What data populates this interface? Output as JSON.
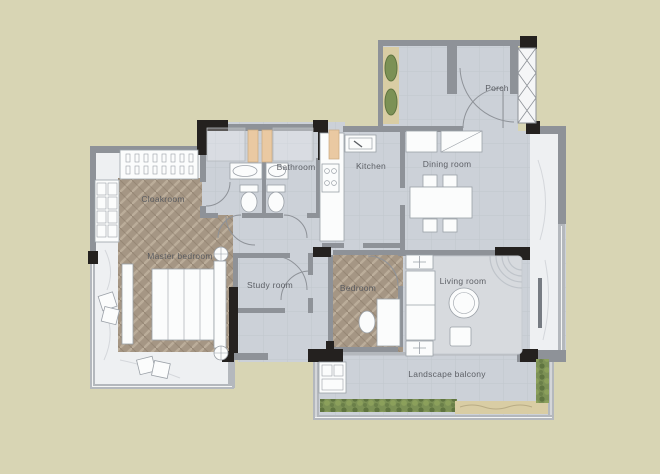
{
  "plan": {
    "title": "Apartment floor plan",
    "rooms": [
      {
        "id": "porch",
        "label": "Porch"
      },
      {
        "id": "bathroom",
        "label": "Bathroom"
      },
      {
        "id": "kitchen",
        "label": "Kitchen"
      },
      {
        "id": "dining-room",
        "label": "Dining room"
      },
      {
        "id": "cloakroom",
        "label": "Cloakroom"
      },
      {
        "id": "master-bedroom",
        "label": "Master bedroom"
      },
      {
        "id": "study-room",
        "label": "Study room"
      },
      {
        "id": "bedroom",
        "label": "Bedroom"
      },
      {
        "id": "living-room",
        "label": "Living room"
      },
      {
        "id": "landscape-balcony",
        "label": "Landscape balcony"
      }
    ],
    "colors": {
      "bg": "#d8d5b4",
      "tile": "#ccd1d8",
      "tileLine": "#b7bdc5",
      "wood": "#a59684",
      "marble": "#eef0f2",
      "wallGray": "#8e9298",
      "wallLight": "#b4b8bd",
      "wallDark": "#24211f",
      "white": "#fbfcfc",
      "stroke": "#9aa0a7",
      "peach": "#eac9a2",
      "green": "#7c9155",
      "greenDark": "#5f7440",
      "sand": "#d9cda4",
      "label": "#53565c",
      "rug": "#d7dade",
      "tv": "#767b82"
    }
  }
}
